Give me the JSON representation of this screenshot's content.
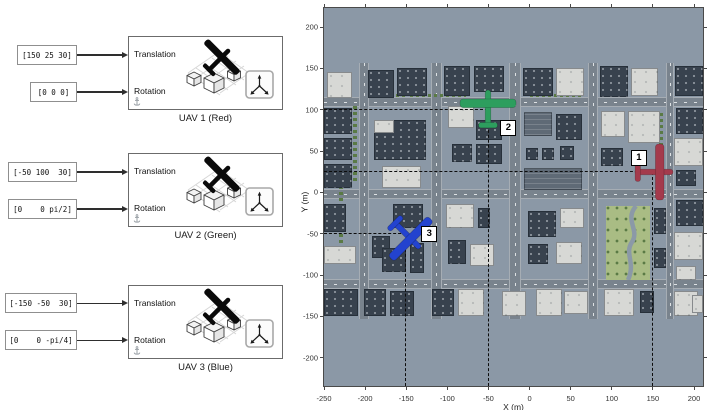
{
  "diagram": {
    "port1": "Translation",
    "port2": "Rotation",
    "groups": [
      {
        "name": "UAV 1 (Red)",
        "translation_value": "[150 25 30]",
        "rotation_value": "[0 0 0]"
      },
      {
        "name": "UAV 2 (Green)",
        "translation_value": "[-50 100  30]",
        "rotation_value": "[0    0 pi/2]"
      },
      {
        "name": "UAV 3 (Blue)",
        "translation_value": "[-150 -50  30]",
        "rotation_value": "[0    0 -pi/4]"
      }
    ]
  },
  "plot": {
    "xlabel": "X (m)",
    "ylabel": "Y (m)",
    "x_ticks": [
      -250,
      -200,
      -150,
      -100,
      -50,
      0,
      50,
      100,
      150,
      200
    ],
    "y_ticks": [
      200,
      150,
      100,
      50,
      0,
      -50,
      -100,
      -150,
      -200
    ],
    "uavs": [
      {
        "marker": "1",
        "color": "#a43a4c",
        "x": 150,
        "y": 25,
        "heading_deg": 90,
        "label_offset": [
          -22,
          -22
        ]
      },
      {
        "marker": "2",
        "color": "#2d9e5e",
        "x": -50,
        "y": 100,
        "heading_deg": 0,
        "label_offset": [
          12,
          10
        ]
      },
      {
        "marker": "3",
        "color": "#2343cf",
        "x": -150,
        "y": -50,
        "heading_deg": 135,
        "label_offset": [
          15,
          -8
        ]
      }
    ]
  },
  "chart_data": {
    "type": "scatter",
    "title": "",
    "xlabel": "X (m)",
    "ylabel": "Y (m)",
    "xlim": [
      -250,
      212
    ],
    "ylim": [
      -234,
      223
    ],
    "points": [
      {
        "label": "1",
        "x": 150,
        "y": 25,
        "color": "#a43a4c"
      },
      {
        "label": "2",
        "x": -50,
        "y": 100,
        "color": "#2d9e5e"
      },
      {
        "label": "3",
        "x": -150,
        "y": -50,
        "color": "#2343cf"
      }
    ],
    "legend": false,
    "grid": false
  },
  "map": {
    "colors": {
      "ground": "#8b98a6",
      "road": "#79838d",
      "walk": "#a6adb4",
      "bdark": "#38424e",
      "blight": "#d7d8d5",
      "bmid": "#5f6a76",
      "park": "#a9bc84",
      "tree": "#5a7a45",
      "river": "#8b99a7"
    },
    "roads_h": [
      [
        89,
        10
      ],
      [
        181,
        10
      ],
      [
        271,
        10
      ]
    ],
    "roads_v": [
      [
        35,
        10
      ],
      [
        107,
        11
      ],
      [
        185,
        12
      ],
      [
        264,
        10
      ],
      [
        342,
        8
      ]
    ],
    "park_rect": [
      282,
      198,
      44,
      74
    ],
    "hedges": [
      [
        29,
        98,
        4,
        78
      ],
      [
        15,
        166,
        4,
        80
      ],
      [
        86,
        86,
        56,
        3
      ],
      [
        206,
        86,
        52,
        3
      ],
      [
        335,
        105,
        4,
        36
      ],
      [
        48,
        86,
        34,
        3
      ]
    ],
    "buildings": [
      [
        3,
        64,
        25,
        26,
        1
      ],
      [
        44,
        62,
        26,
        28,
        0
      ],
      [
        73,
        60,
        30,
        28,
        0
      ],
      [
        120,
        58,
        26,
        30,
        0
      ],
      [
        150,
        58,
        30,
        26,
        0
      ],
      [
        199,
        60,
        30,
        28,
        0
      ],
      [
        232,
        60,
        28,
        28,
        1
      ],
      [
        276,
        58,
        28,
        31,
        0
      ],
      [
        307,
        60,
        27,
        28,
        1
      ],
      [
        351,
        58,
        28,
        30,
        0
      ],
      [
        0,
        100,
        28,
        26,
        0
      ],
      [
        0,
        130,
        28,
        22,
        0
      ],
      [
        0,
        156,
        28,
        24,
        0
      ],
      [
        50,
        112,
        52,
        40,
        0
      ],
      [
        50,
        112,
        20,
        13,
        1
      ],
      [
        58,
        158,
        39,
        22,
        1
      ],
      [
        124,
        98,
        26,
        22,
        1
      ],
      [
        152,
        112,
        26,
        20,
        0
      ],
      [
        128,
        136,
        20,
        18,
        0
      ],
      [
        152,
        136,
        26,
        20,
        0
      ],
      [
        200,
        104,
        28,
        24,
        2
      ],
      [
        232,
        106,
        26,
        26,
        0
      ],
      [
        202,
        140,
        12,
        12,
        0
      ],
      [
        218,
        140,
        12,
        12,
        0
      ],
      [
        236,
        138,
        14,
        14,
        0
      ],
      [
        200,
        160,
        58,
        22,
        2
      ],
      [
        277,
        103,
        24,
        26,
        1
      ],
      [
        304,
        103,
        32,
        32,
        1
      ],
      [
        277,
        140,
        22,
        18,
        0
      ],
      [
        352,
        100,
        27,
        26,
        0
      ],
      [
        350,
        130,
        29,
        28,
        1
      ],
      [
        352,
        162,
        20,
        16,
        0
      ],
      [
        0,
        196,
        22,
        28,
        0
      ],
      [
        0,
        238,
        32,
        18,
        1
      ],
      [
        69,
        196,
        30,
        24,
        0
      ],
      [
        48,
        228,
        18,
        22,
        0
      ],
      [
        58,
        240,
        24,
        24,
        0
      ],
      [
        86,
        235,
        14,
        30,
        0
      ],
      [
        122,
        196,
        28,
        24,
        1
      ],
      [
        154,
        200,
        12,
        20,
        0
      ],
      [
        124,
        232,
        18,
        24,
        0
      ],
      [
        146,
        236,
        24,
        22,
        1
      ],
      [
        204,
        203,
        28,
        26,
        0
      ],
      [
        236,
        200,
        24,
        20,
        1
      ],
      [
        204,
        236,
        20,
        20,
        0
      ],
      [
        232,
        234,
        26,
        22,
        1
      ],
      [
        330,
        200,
        12,
        26,
        0
      ],
      [
        330,
        240,
        12,
        20,
        0
      ],
      [
        352,
        192,
        27,
        26,
        0
      ],
      [
        350,
        224,
        29,
        28,
        1
      ],
      [
        352,
        258,
        20,
        14,
        1
      ],
      [
        0,
        281,
        34,
        27,
        0
      ],
      [
        40,
        281,
        22,
        27,
        0
      ],
      [
        66,
        283,
        24,
        25,
        0
      ],
      [
        108,
        281,
        22,
        27,
        0
      ],
      [
        134,
        281,
        26,
        27,
        1
      ],
      [
        178,
        283,
        24,
        25,
        1
      ],
      [
        212,
        281,
        26,
        27,
        1
      ],
      [
        240,
        283,
        24,
        23,
        1
      ],
      [
        280,
        281,
        30,
        27,
        1
      ],
      [
        316,
        283,
        14,
        22,
        0
      ],
      [
        350,
        283,
        24,
        25,
        1
      ],
      [
        368,
        287,
        11,
        18,
        1
      ]
    ]
  }
}
